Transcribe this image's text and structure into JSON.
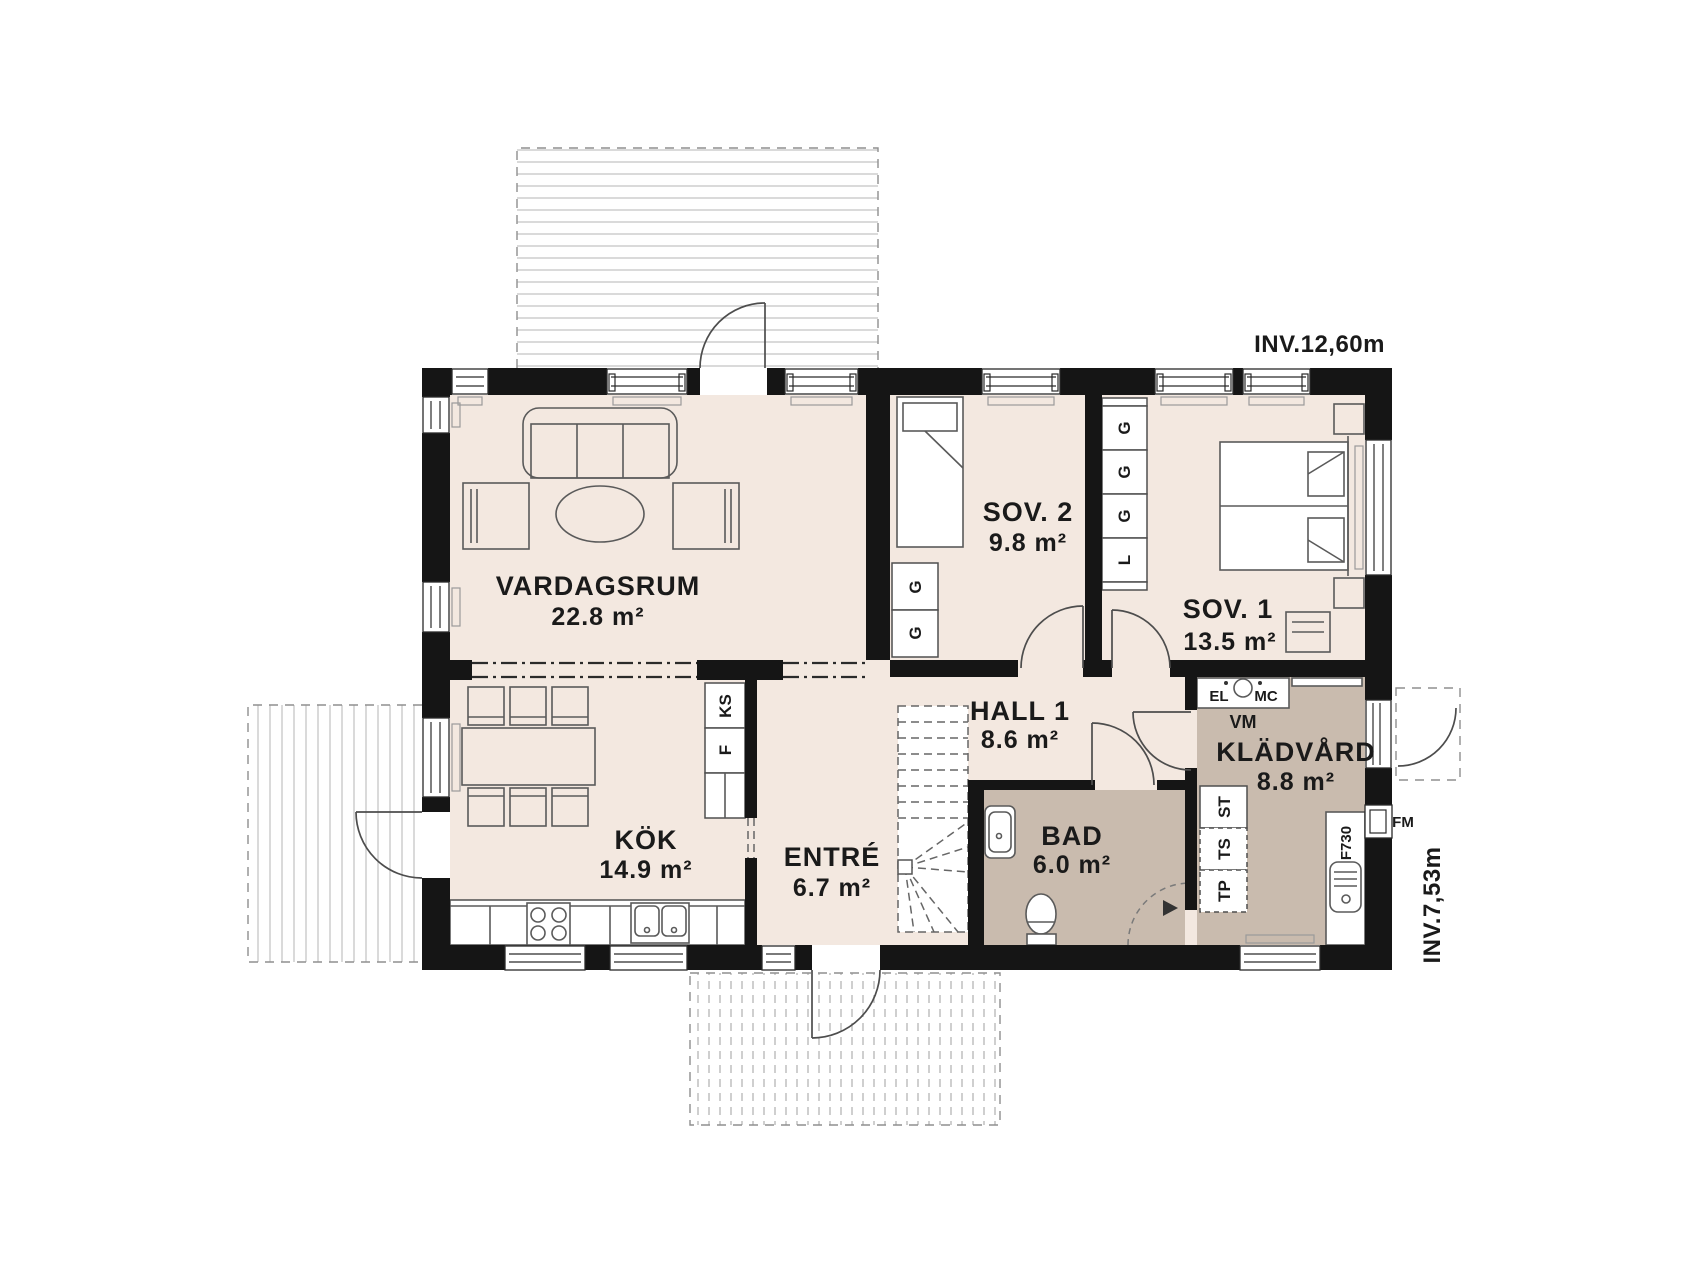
{
  "annotations": {
    "inv_width": "INV.12,60m",
    "inv_height": "INV.7,53m"
  },
  "rooms": {
    "vardagsrum": {
      "name": "VARDAGSRUM",
      "area": "22.8 m²"
    },
    "kok": {
      "name": "KÖK",
      "area": "14.9 m²"
    },
    "entre": {
      "name": "ENTRÉ",
      "area": "6.7 m²"
    },
    "hall": {
      "name": "HALL 1",
      "area": "8.6 m²"
    },
    "sov2": {
      "name": "SOV. 2",
      "area": "9.8 m²"
    },
    "sov1": {
      "name": "SOV. 1",
      "area": "13.5 m²"
    },
    "bad": {
      "name": "BAD",
      "area": "6.0 m²"
    },
    "kladvard": {
      "name": "KLÄDVÅRD",
      "area": "8.8 m²"
    }
  },
  "cabinets": {
    "sov1_strip": [
      "G",
      "G",
      "G",
      "L"
    ],
    "sov2_strip": [
      "G",
      "G"
    ],
    "kitchen": [
      "KS",
      "F"
    ],
    "laundry": [
      "ST",
      "TS",
      "TP"
    ]
  },
  "appliances": {
    "washer": "VM",
    "electrical": "EL",
    "media": "MC",
    "fresh_air": "FM",
    "sink_unit": "F730"
  },
  "colors": {
    "wall": "#151515",
    "room": "#f3e8e0",
    "wet_room": "#c9bbae",
    "deck_line": "#c6c6c6"
  }
}
